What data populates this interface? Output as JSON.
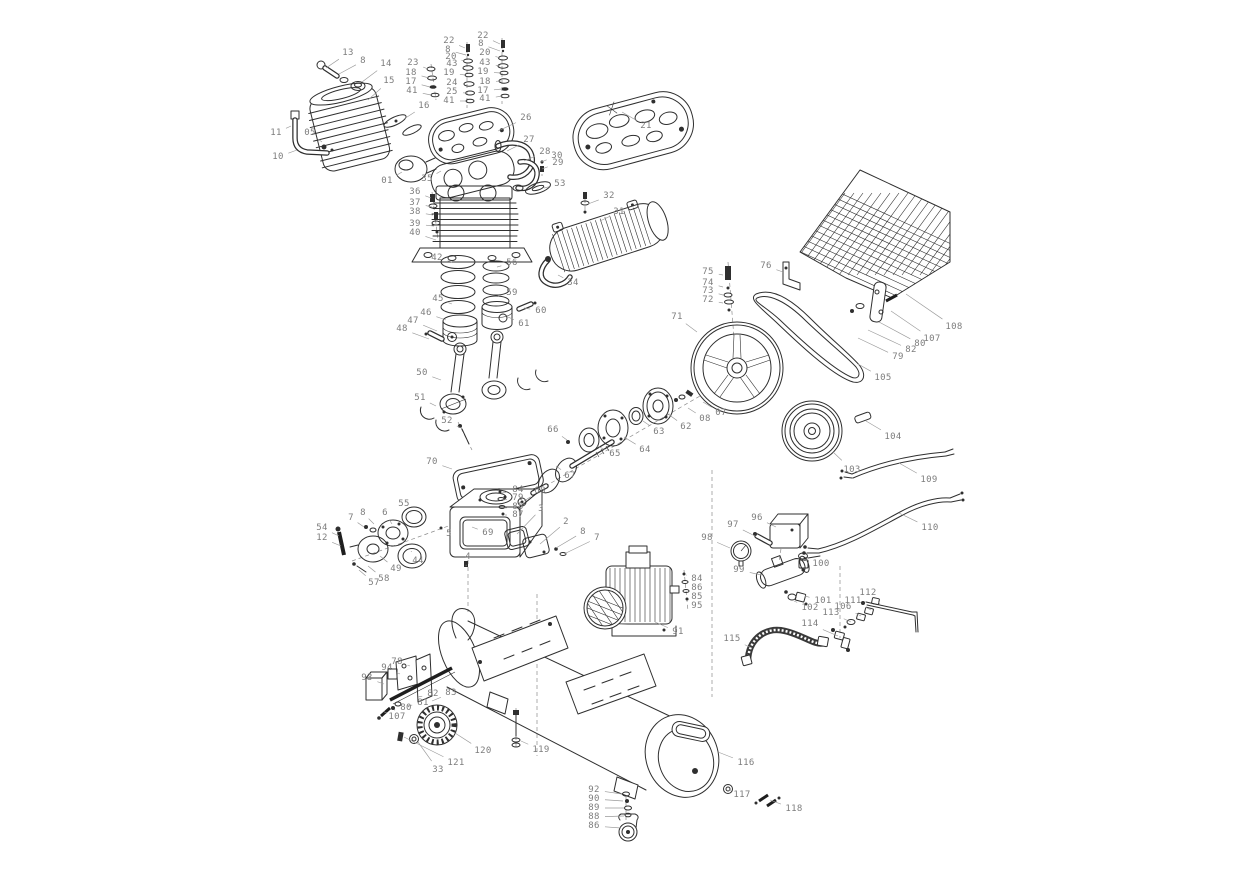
{
  "meta": {
    "description": "Exploded parts diagram of a belt-driven air compressor",
    "canvas_width": 1242,
    "canvas_height": 872
  },
  "colors": {
    "background": "#ffffff",
    "line": "#2f2f2f",
    "label_text": "#7d7d7d",
    "leader_line": "#9a9a9a",
    "dashed_line": "#8c8c8c"
  },
  "labels": [
    {
      "t": "13",
      "x": 348,
      "y": 53,
      "lx": 326,
      "ly": 68
    },
    {
      "t": "8",
      "x": 363,
      "y": 61,
      "lx": 339,
      "ly": 74
    },
    {
      "t": "14",
      "x": 386,
      "y": 64,
      "lx": 362,
      "ly": 82
    },
    {
      "t": "15",
      "x": 389,
      "y": 81,
      "lx": 368,
      "ly": 100
    },
    {
      "t": "11",
      "x": 276,
      "y": 133,
      "lx": 291,
      "ly": 126
    },
    {
      "t": "05",
      "x": 310,
      "y": 133,
      "lx": 322,
      "ly": 142
    },
    {
      "t": "10",
      "x": 278,
      "y": 157,
      "lx": 297,
      "ly": 150
    },
    {
      "t": "23",
      "x": 413,
      "y": 63,
      "lx": 428,
      "ly": 69
    },
    {
      "t": "18",
      "x": 411,
      "y": 73,
      "lx": 429,
      "ly": 78
    },
    {
      "t": "17",
      "x": 411,
      "y": 82,
      "lx": 430,
      "ly": 87
    },
    {
      "t": "41",
      "x": 412,
      "y": 91,
      "lx": 431,
      "ly": 95
    },
    {
      "t": "16",
      "x": 424,
      "y": 106,
      "lx": 404,
      "ly": 119
    },
    {
      "t": "22",
      "x": 449,
      "y": 41,
      "lx": 465,
      "ly": 48
    },
    {
      "t": "8",
      "x": 448,
      "y": 50,
      "lx": 466,
      "ly": 55
    },
    {
      "t": "20",
      "x": 451,
      "y": 57,
      "lx": 464,
      "ly": 61
    },
    {
      "t": "43",
      "x": 452,
      "y": 64,
      "lx": 464,
      "ly": 68
    },
    {
      "t": "19",
      "x": 449,
      "y": 73,
      "lx": 465,
      "ly": 75
    },
    {
      "t": "24",
      "x": 452,
      "y": 83,
      "lx": 465,
      "ly": 84
    },
    {
      "t": "25",
      "x": 452,
      "y": 92,
      "lx": 466,
      "ly": 93
    },
    {
      "t": "41",
      "x": 449,
      "y": 101,
      "lx": 466,
      "ly": 101
    },
    {
      "t": "22",
      "x": 483,
      "y": 36,
      "lx": 500,
      "ly": 44
    },
    {
      "t": "8",
      "x": 481,
      "y": 44,
      "lx": 500,
      "ly": 51
    },
    {
      "t": "20",
      "x": 485,
      "y": 53,
      "lx": 500,
      "ly": 58
    },
    {
      "t": "43",
      "x": 485,
      "y": 63,
      "lx": 500,
      "ly": 66
    },
    {
      "t": "19",
      "x": 483,
      "y": 72,
      "lx": 501,
      "ly": 73
    },
    {
      "t": "18",
      "x": 485,
      "y": 82,
      "lx": 501,
      "ly": 81
    },
    {
      "t": "17",
      "x": 483,
      "y": 91,
      "lx": 502,
      "ly": 89
    },
    {
      "t": "41",
      "x": 485,
      "y": 99,
      "lx": 502,
      "ly": 96
    },
    {
      "t": "26",
      "x": 526,
      "y": 118,
      "lx": 498,
      "ly": 131
    },
    {
      "t": "21",
      "x": 646,
      "y": 126,
      "lx": 622,
      "ly": 112
    },
    {
      "t": "27",
      "x": 529,
      "y": 140,
      "lx": 507,
      "ly": 151
    },
    {
      "t": "28",
      "x": 545,
      "y": 152,
      "lx": 524,
      "ly": 161
    },
    {
      "t": "30",
      "x": 557,
      "y": 156,
      "lx": 541,
      "ly": 162
    },
    {
      "t": "29",
      "x": 558,
      "y": 163,
      "lx": 542,
      "ly": 169
    },
    {
      "t": "53",
      "x": 560,
      "y": 184,
      "lx": 544,
      "ly": 188
    },
    {
      "t": "01",
      "x": 387,
      "y": 181,
      "lx": 402,
      "ly": 172
    },
    {
      "t": "35",
      "x": 427,
      "y": 179,
      "lx": 441,
      "ly": 171
    },
    {
      "t": "36",
      "x": 415,
      "y": 192,
      "lx": 431,
      "ly": 198
    },
    {
      "t": "37",
      "x": 415,
      "y": 203,
      "lx": 432,
      "ly": 207
    },
    {
      "t": "38",
      "x": 415,
      "y": 212,
      "lx": 433,
      "ly": 215
    },
    {
      "t": "39",
      "x": 415,
      "y": 224,
      "lx": 434,
      "ly": 226
    },
    {
      "t": "40",
      "x": 415,
      "y": 233,
      "lx": 436,
      "ly": 240
    },
    {
      "t": "32",
      "x": 609,
      "y": 196,
      "lx": 588,
      "ly": 204
    },
    {
      "t": "31",
      "x": 619,
      "y": 212,
      "lx": 600,
      "ly": 221
    },
    {
      "t": "34",
      "x": 573,
      "y": 283,
      "lx": 558,
      "ly": 275
    },
    {
      "t": "42",
      "x": 437,
      "y": 258,
      "lx": 452,
      "ly": 262
    },
    {
      "t": "56",
      "x": 512,
      "y": 263,
      "lx": 497,
      "ly": 267
    },
    {
      "t": "45",
      "x": 438,
      "y": 299,
      "lx": 452,
      "ly": 304
    },
    {
      "t": "59",
      "x": 512,
      "y": 293,
      "lx": 498,
      "ly": 296
    },
    {
      "t": "60",
      "x": 541,
      "y": 311,
      "lx": 524,
      "ly": 308
    },
    {
      "t": "61",
      "x": 524,
      "y": 324,
      "lx": 508,
      "ly": 317
    },
    {
      "t": "46",
      "x": 426,
      "y": 313,
      "lx": 446,
      "ly": 320
    },
    {
      "t": "47",
      "x": 413,
      "y": 321,
      "lx": 437,
      "ly": 331
    },
    {
      "t": "48",
      "x": 402,
      "y": 329,
      "lx": 429,
      "ly": 339
    },
    {
      "t": "50",
      "x": 422,
      "y": 373,
      "lx": 441,
      "ly": 380
    },
    {
      "t": "51",
      "x": 420,
      "y": 398,
      "lx": 436,
      "ly": 406
    },
    {
      "t": "52",
      "x": 447,
      "y": 421,
      "lx": 461,
      "ly": 428
    },
    {
      "t": "70",
      "x": 432,
      "y": 462,
      "lx": 452,
      "ly": 469
    },
    {
      "t": "66",
      "x": 553,
      "y": 430,
      "lx": 567,
      "ly": 440
    },
    {
      "t": "65",
      "x": 615,
      "y": 454,
      "lx": 597,
      "ly": 446
    },
    {
      "t": "64",
      "x": 645,
      "y": 450,
      "lx": 624,
      "ly": 437
    },
    {
      "t": "63",
      "x": 659,
      "y": 432,
      "lx": 643,
      "ly": 421
    },
    {
      "t": "62",
      "x": 686,
      "y": 427,
      "lx": 668,
      "ly": 414
    },
    {
      "t": "08",
      "x": 705,
      "y": 419,
      "lx": 688,
      "ly": 408
    },
    {
      "t": "07",
      "x": 721,
      "y": 413,
      "lx": 703,
      "ly": 402
    },
    {
      "t": "67",
      "x": 570,
      "y": 476,
      "lx": 556,
      "ly": 466
    },
    {
      "t": "68",
      "x": 540,
      "y": 491,
      "lx": 524,
      "ly": 501
    },
    {
      "t": "84",
      "x": 518,
      "y": 490,
      "lx": 502,
      "ly": 493
    },
    {
      "t": "79",
      "x": 518,
      "y": 498,
      "lx": 503,
      "ly": 500
    },
    {
      "t": "85",
      "x": 518,
      "y": 507,
      "lx": 504,
      "ly": 508
    },
    {
      "t": "87",
      "x": 518,
      "y": 515,
      "lx": 505,
      "ly": 515
    },
    {
      "t": "3",
      "x": 541,
      "y": 509,
      "lx": 517,
      "ly": 534
    },
    {
      "t": "2",
      "x": 566,
      "y": 522,
      "lx": 540,
      "ly": 544
    },
    {
      "t": "8",
      "x": 583,
      "y": 532,
      "lx": 556,
      "ly": 548
    },
    {
      "t": "7",
      "x": 597,
      "y": 538,
      "lx": 564,
      "ly": 554
    },
    {
      "t": "69",
      "x": 488,
      "y": 533,
      "lx": 472,
      "ly": 527
    },
    {
      "t": "5",
      "x": 449,
      "y": 534,
      "lx": 442,
      "ly": 529
    },
    {
      "t": "4",
      "x": 468,
      "y": 557,
      "lx": 466,
      "ly": 566
    },
    {
      "t": "54",
      "x": 322,
      "y": 528,
      "lx": 339,
      "ly": 536
    },
    {
      "t": "12",
      "x": 322,
      "y": 538,
      "lx": 341,
      "ly": 546
    },
    {
      "t": "7",
      "x": 351,
      "y": 518,
      "lx": 364,
      "ly": 527
    },
    {
      "t": "8",
      "x": 363,
      "y": 513,
      "lx": 374,
      "ly": 524
    },
    {
      "t": "6",
      "x": 385,
      "y": 513,
      "lx": 392,
      "ly": 524
    },
    {
      "t": "55",
      "x": 404,
      "y": 504,
      "lx": 411,
      "ly": 513
    },
    {
      "t": "44",
      "x": 418,
      "y": 561,
      "lx": 411,
      "ly": 551
    },
    {
      "t": "49",
      "x": 396,
      "y": 569,
      "lx": 380,
      "ly": 556
    },
    {
      "t": "58",
      "x": 384,
      "y": 579,
      "lx": 368,
      "ly": 566
    },
    {
      "t": "57",
      "x": 374,
      "y": 583,
      "lx": 359,
      "ly": 570
    },
    {
      "t": "71",
      "x": 677,
      "y": 317,
      "lx": 697,
      "ly": 332
    },
    {
      "t": "75",
      "x": 708,
      "y": 272,
      "lx": 723,
      "ly": 275
    },
    {
      "t": "74",
      "x": 708,
      "y": 283,
      "lx": 723,
      "ly": 287
    },
    {
      "t": "73",
      "x": 708,
      "y": 291,
      "lx": 723,
      "ly": 295
    },
    {
      "t": "72",
      "x": 708,
      "y": 300,
      "lx": 723,
      "ly": 303
    },
    {
      "t": "76",
      "x": 766,
      "y": 266,
      "lx": 783,
      "ly": 272
    },
    {
      "t": "105",
      "x": 883,
      "y": 378,
      "lx": 858,
      "ly": 364
    },
    {
      "t": "108",
      "x": 954,
      "y": 327,
      "lx": 906,
      "ly": 294
    },
    {
      "t": "107",
      "x": 932,
      "y": 339,
      "lx": 891,
      "ly": 311
    },
    {
      "t": "80",
      "x": 920,
      "y": 344,
      "lx": 879,
      "ly": 322
    },
    {
      "t": "82",
      "x": 911,
      "y": 350,
      "lx": 868,
      "ly": 330
    },
    {
      "t": "79",
      "x": 898,
      "y": 357,
      "lx": 858,
      "ly": 338
    },
    {
      "t": "104",
      "x": 893,
      "y": 437,
      "lx": 866,
      "ly": 421
    },
    {
      "t": "103",
      "x": 852,
      "y": 470,
      "lx": 833,
      "ly": 452
    },
    {
      "t": "109",
      "x": 929,
      "y": 480,
      "lx": 899,
      "ly": 463
    },
    {
      "t": "110",
      "x": 930,
      "y": 528,
      "lx": 899,
      "ly": 513
    },
    {
      "t": "96",
      "x": 757,
      "y": 518,
      "lx": 776,
      "ly": 527
    },
    {
      "t": "97",
      "x": 733,
      "y": 525,
      "lx": 755,
      "ly": 536
    },
    {
      "t": "98",
      "x": 707,
      "y": 538,
      "lx": 730,
      "ly": 548
    },
    {
      "t": "99",
      "x": 739,
      "y": 570,
      "lx": 761,
      "ly": 575
    },
    {
      "t": "100",
      "x": 821,
      "y": 564,
      "lx": 803,
      "ly": 559
    },
    {
      "t": "101",
      "x": 823,
      "y": 601,
      "lx": 805,
      "ly": 596
    },
    {
      "t": "102",
      "x": 810,
      "y": 608,
      "lx": 794,
      "ly": 601
    },
    {
      "t": "112",
      "x": 868,
      "y": 593,
      "lx": 880,
      "ly": 604
    },
    {
      "t": "111",
      "x": 853,
      "y": 601,
      "lx": 871,
      "ly": 610
    },
    {
      "t": "106",
      "x": 843,
      "y": 607,
      "lx": 861,
      "ly": 616
    },
    {
      "t": "113",
      "x": 831,
      "y": 613,
      "lx": 851,
      "ly": 622
    },
    {
      "t": "114",
      "x": 810,
      "y": 624,
      "lx": 838,
      "ly": 636
    },
    {
      "t": "115",
      "x": 732,
      "y": 639,
      "lx": 752,
      "ly": 648
    },
    {
      "t": "84",
      "x": 697,
      "y": 579,
      "lx": 686,
      "ly": 575
    },
    {
      "t": "86",
      "x": 697,
      "y": 588,
      "lx": 687,
      "ly": 583
    },
    {
      "t": "85",
      "x": 697,
      "y": 597,
      "lx": 688,
      "ly": 592
    },
    {
      "t": "95",
      "x": 697,
      "y": 606,
      "lx": 689,
      "ly": 600
    },
    {
      "t": "91",
      "x": 678,
      "y": 632,
      "lx": 655,
      "ly": 622
    },
    {
      "t": "78",
      "x": 397,
      "y": 662,
      "lx": 410,
      "ly": 666
    },
    {
      "t": "94",
      "x": 387,
      "y": 668,
      "lx": 400,
      "ly": 674
    },
    {
      "t": "93",
      "x": 367,
      "y": 678,
      "lx": 384,
      "ly": 684
    },
    {
      "t": "82",
      "x": 433,
      "y": 694,
      "lx": 418,
      "ly": 697
    },
    {
      "t": "83",
      "x": 451,
      "y": 693,
      "lx": 432,
      "ly": 701
    },
    {
      "t": "81",
      "x": 423,
      "y": 703,
      "lx": 407,
      "ly": 706
    },
    {
      "t": "80",
      "x": 406,
      "y": 708,
      "lx": 394,
      "ly": 710
    },
    {
      "t": "107",
      "x": 397,
      "y": 717,
      "lx": 387,
      "ly": 713
    },
    {
      "t": "120",
      "x": 483,
      "y": 751,
      "lx": 455,
      "ly": 733
    },
    {
      "t": "121",
      "x": 456,
      "y": 763,
      "lx": 404,
      "ly": 737
    },
    {
      "t": "33",
      "x": 438,
      "y": 770,
      "lx": 418,
      "ly": 742
    },
    {
      "t": "119",
      "x": 541,
      "y": 750,
      "lx": 521,
      "ly": 741
    },
    {
      "t": "116",
      "x": 746,
      "y": 763,
      "lx": 718,
      "ly": 752
    },
    {
      "t": "117",
      "x": 742,
      "y": 795,
      "lx": 731,
      "ly": 791
    },
    {
      "t": "118",
      "x": 794,
      "y": 809,
      "lx": 770,
      "ly": 800
    },
    {
      "t": "92",
      "x": 594,
      "y": 790,
      "lx": 622,
      "ly": 794
    },
    {
      "t": "90",
      "x": 594,
      "y": 799,
      "lx": 623,
      "ly": 801
    },
    {
      "t": "89",
      "x": 594,
      "y": 808,
      "lx": 624,
      "ly": 808
    },
    {
      "t": "88",
      "x": 594,
      "y": 817,
      "lx": 624,
      "ly": 816
    },
    {
      "t": "86",
      "x": 594,
      "y": 826,
      "lx": 621,
      "ly": 828
    }
  ]
}
